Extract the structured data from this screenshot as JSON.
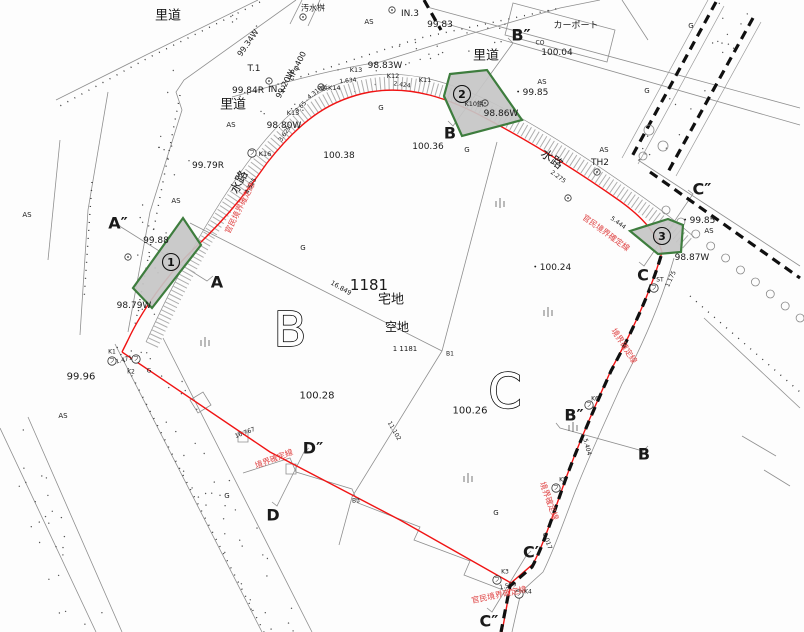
{
  "map": {
    "colors": {
      "boundary_red": "#f01414",
      "red_text": "#e04848",
      "line_gray": "#8f8f8f",
      "tick_gray": "#aeaeae",
      "text_black": "#1a1a1a",
      "parcel_fill": "#c6c6c6",
      "parcel_stroke": "#3e7d3e"
    },
    "labels": [
      {
        "id": "rido-1",
        "t": "里道",
        "x": 168,
        "y": 16,
        "s": 13
      },
      {
        "id": "osuimasu",
        "t": "汚水桝",
        "x": 313,
        "y": 8,
        "s": 8
      },
      {
        "id": "as-1",
        "t": "AS",
        "x": 369,
        "y": 22,
        "s": 7
      },
      {
        "id": "in3",
        "t": "IN.3",
        "x": 410,
        "y": 14,
        "s": 9
      },
      {
        "id": "elev-99-83",
        "t": "99.83",
        "x": 440,
        "y": 25,
        "s": 9
      },
      {
        "id": "sec-b2-top",
        "t": "B″",
        "x": 521,
        "y": 35,
        "s": 16,
        "b": 1
      },
      {
        "id": "co",
        "t": "CO",
        "x": 540,
        "y": 43,
        "s": 6
      },
      {
        "id": "carport",
        "t": "カーポート",
        "x": 576,
        "y": 26,
        "s": 9
      },
      {
        "id": "elev-100-04",
        "t": "100.04",
        "x": 557,
        "y": 53,
        "s": 9
      },
      {
        "id": "rido-2",
        "t": "里道",
        "x": 486,
        "y": 56,
        "s": 13
      },
      {
        "id": "elev-99-34w",
        "t": "99.34W",
        "x": 248,
        "y": 43,
        "s": 8,
        "r": -55
      },
      {
        "id": "t1",
        "t": "T.1",
        "x": 254,
        "y": 69,
        "s": 9
      },
      {
        "id": "hp400",
        "t": "HPφ400",
        "x": 297,
        "y": 66,
        "s": 8,
        "r": -63
      },
      {
        "id": "elev-99-20w",
        "t": "99.20W",
        "x": 285,
        "y": 84,
        "s": 8,
        "r": -63
      },
      {
        "id": "elev-99-84r",
        "t": "99.84R",
        "x": 248,
        "y": 91,
        "s": 9
      },
      {
        "id": "in2",
        "t": "IN.2",
        "x": 277,
        "y": 90,
        "s": 9
      },
      {
        "id": "rido-3",
        "t": "里道",
        "x": 233,
        "y": 105,
        "s": 13
      },
      {
        "id": "k13",
        "t": "K13",
        "x": 356,
        "y": 70,
        "s": 6.5
      },
      {
        "id": "elev-98-83w",
        "t": "98.83W",
        "x": 385,
        "y": 66,
        "s": 9
      },
      {
        "id": "k12",
        "t": "K12",
        "x": 393,
        "y": 76,
        "s": 6.5
      },
      {
        "id": "k11",
        "t": "K11",
        "x": 425,
        "y": 80,
        "s": 6.5
      },
      {
        "id": "k14",
        "t": "鋲K14",
        "x": 331,
        "y": 88,
        "s": 6.5
      },
      {
        "id": "k15",
        "t": "K15",
        "x": 293,
        "y": 113,
        "s": 6.5
      },
      {
        "id": "elev-98-80w",
        "t": "98.80W",
        "x": 284,
        "y": 126,
        "s": 9
      },
      {
        "id": "as-2",
        "t": "AS",
        "x": 231,
        "y": 125,
        "s": 7
      },
      {
        "id": "k16",
        "t": "K16",
        "x": 265,
        "y": 154,
        "s": 6.5
      },
      {
        "id": "elev-99-79r",
        "t": "99.79R",
        "x": 208,
        "y": 166,
        "s": 9
      },
      {
        "id": "suiro-1",
        "t": "水路",
        "x": 239,
        "y": 182,
        "s": 12,
        "r": -63
      },
      {
        "id": "as-3",
        "t": "AS",
        "x": 176,
        "y": 201,
        "s": 7
      },
      {
        "id": "as-4",
        "t": "AS",
        "x": 27,
        "y": 215,
        "s": 7
      },
      {
        "id": "g-1",
        "t": "G",
        "x": 381,
        "y": 108,
        "s": 7
      },
      {
        "id": "g-2",
        "t": "G",
        "x": 467,
        "y": 150,
        "s": 7
      },
      {
        "id": "elev-100-38",
        "t": "100.38",
        "x": 339,
        "y": 156,
        "s": 9
      },
      {
        "id": "elev-100-36",
        "t": "100.36",
        "x": 428,
        "y": 147,
        "s": 9
      },
      {
        "id": "sec-b-top",
        "t": "B",
        "x": 450,
        "y": 133,
        "s": 16,
        "b": 1
      },
      {
        "id": "suiro-2",
        "t": "水路",
        "x": 552,
        "y": 159,
        "s": 12,
        "r": 36
      },
      {
        "id": "as-5",
        "t": "AS",
        "x": 604,
        "y": 150,
        "s": 7
      },
      {
        "id": "th2",
        "t": "TH2",
        "x": 600,
        "y": 163,
        "s": 9
      },
      {
        "id": "k10",
        "t": "K10鋲",
        "x": 474,
        "y": 104,
        "s": 6.5
      },
      {
        "id": "elev-98-86w",
        "t": "98.86W",
        "x": 501,
        "y": 114,
        "s": 9
      },
      {
        "id": "elev-99-85a",
        "t": "・99.85",
        "x": 531,
        "y": 93,
        "s": 9
      },
      {
        "id": "as-6",
        "t": "AS",
        "x": 542,
        "y": 82,
        "s": 7
      },
      {
        "id": "g-3",
        "t": "G",
        "x": 691,
        "y": 26,
        "s": 7
      },
      {
        "id": "g-4",
        "t": "G",
        "x": 647,
        "y": 91,
        "s": 7
      },
      {
        "id": "sec-c2-top",
        "t": "C″",
        "x": 702,
        "y": 189,
        "s": 16,
        "b": 1
      },
      {
        "id": "elev-99-85b",
        "t": "・99.85",
        "x": 698,
        "y": 221,
        "s": 9
      },
      {
        "id": "as-7",
        "t": "AS",
        "x": 709,
        "y": 231,
        "s": 7
      },
      {
        "id": "elev-98-87w",
        "t": "98.87W",
        "x": 692,
        "y": 258,
        "s": 9
      },
      {
        "id": "sec-c-top",
        "t": "C",
        "x": 643,
        "y": 275,
        "s": 16,
        "b": 1
      },
      {
        "id": "elev-100-24",
        "t": "・100.24",
        "x": 551,
        "y": 268,
        "s": 9
      },
      {
        "id": "d-5444",
        "t": "5.444",
        "x": 618,
        "y": 223,
        "s": 6,
        "r": 36
      },
      {
        "id": "d-2275",
        "t": "2.275",
        "x": 558,
        "y": 177,
        "s": 6,
        "r": 36
      },
      {
        "id": "d-1175",
        "t": "1.175",
        "x": 671,
        "y": 279,
        "s": 6,
        "r": -65
      },
      {
        "id": "st",
        "t": "ST",
        "x": 660,
        "y": 280,
        "s": 6
      },
      {
        "id": "red-1",
        "t": "官民境界確定線",
        "x": 240,
        "y": 208,
        "s": 8,
        "r": -63,
        "c": "red"
      },
      {
        "id": "red-2",
        "t": "官民境界確定線",
        "x": 606,
        "y": 233,
        "s": 8,
        "r": 36,
        "c": "red"
      },
      {
        "id": "red-3",
        "t": "官民境界確定線",
        "x": 499,
        "y": 595,
        "s": 8,
        "r": -12,
        "c": "red"
      },
      {
        "id": "red-4",
        "t": "境界確定線",
        "x": 274,
        "y": 459,
        "s": 8,
        "r": -21,
        "c": "red"
      },
      {
        "id": "red-5",
        "t": "境界確定線",
        "x": 624,
        "y": 346,
        "s": 8,
        "r": 57,
        "c": "red"
      },
      {
        "id": "red-6",
        "t": "境界確定線",
        "x": 549,
        "y": 501,
        "s": 8,
        "r": 70,
        "c": "red"
      },
      {
        "id": "sec-a2",
        "t": "A″",
        "x": 118,
        "y": 223,
        "s": 16,
        "b": 1
      },
      {
        "id": "elev-99-88",
        "t": "99.88",
        "x": 156,
        "y": 241,
        "s": 9
      },
      {
        "id": "sec-a",
        "t": "A",
        "x": 217,
        "y": 282,
        "s": 16,
        "b": 1
      },
      {
        "id": "elev-98-79w",
        "t": "98.79W",
        "x": 134,
        "y": 306,
        "s": 9
      },
      {
        "id": "elev-99-96",
        "t": "99.96",
        "x": 81,
        "y": 377,
        "s": 10
      },
      {
        "id": "as-8",
        "t": "AS",
        "x": 63,
        "y": 416,
        "s": 7
      },
      {
        "id": "k1",
        "t": "K1",
        "x": 112,
        "y": 352,
        "s": 6
      },
      {
        "id": "d-1471",
        "t": "1.471",
        "x": 124,
        "y": 360,
        "s": 6,
        "r": -15
      },
      {
        "id": "k2",
        "t": "K2",
        "x": 131,
        "y": 372,
        "s": 6
      },
      {
        "id": "g-5",
        "t": "G",
        "x": 149,
        "y": 371,
        "s": 6
      },
      {
        "id": "g-6",
        "t": "G",
        "x": 303,
        "y": 248,
        "s": 7
      },
      {
        "id": "lot-1181",
        "t": "1181",
        "x": 369,
        "y": 285,
        "s": 15
      },
      {
        "id": "takuchi",
        "t": "宅地",
        "x": 391,
        "y": 300,
        "s": 13
      },
      {
        "id": "akichi",
        "t": "空地",
        "x": 397,
        "y": 327,
        "s": 12
      },
      {
        "id": "lot-ref",
        "t": "1 1181",
        "x": 405,
        "y": 349,
        "s": 7
      },
      {
        "id": "b1",
        "t": "B1",
        "x": 450,
        "y": 354,
        "s": 6
      },
      {
        "id": "d-16849",
        "t": "16.849",
        "x": 341,
        "y": 288,
        "s": 6.5,
        "r": 30
      },
      {
        "id": "elev-100-28",
        "t": "100.28",
        "x": 317,
        "y": 396,
        "s": 10
      },
      {
        "id": "elev-100-26",
        "t": "100.26",
        "x": 470,
        "y": 411,
        "s": 10
      },
      {
        "id": "parcel-b",
        "t": "B",
        "x": 290,
        "y": 330,
        "s": 48,
        "o": 1
      },
      {
        "id": "parcel-c",
        "t": "C",
        "x": 505,
        "y": 392,
        "s": 48,
        "o": 1
      },
      {
        "id": "sec-b2-right",
        "t": "B″",
        "x": 574,
        "y": 415,
        "s": 16,
        "b": 1
      },
      {
        "id": "sec-b-right",
        "t": "B",
        "x": 644,
        "y": 454,
        "s": 16,
        "b": 1
      },
      {
        "id": "k6",
        "t": "K6",
        "x": 595,
        "y": 399,
        "s": 6
      },
      {
        "id": "k5",
        "t": "K5",
        "x": 563,
        "y": 480,
        "s": 6
      },
      {
        "id": "d-5404",
        "t": "5.404",
        "x": 587,
        "y": 447,
        "s": 6,
        "r": 75
      },
      {
        "id": "d-8017",
        "t": "8.017",
        "x": 547,
        "y": 541,
        "s": 6,
        "r": 70
      },
      {
        "id": "sec-d2",
        "t": "D″",
        "x": 313,
        "y": 448,
        "s": 16,
        "b": 1
      },
      {
        "id": "sec-d",
        "t": "D",
        "x": 273,
        "y": 515,
        "s": 16,
        "b": 1
      },
      {
        "id": "d-16767",
        "t": "16.767",
        "x": 245,
        "y": 433,
        "s": 6,
        "r": -21
      },
      {
        "id": "d-11102",
        "t": "11.102",
        "x": 394,
        "y": 431,
        "s": 6,
        "r": 60
      },
      {
        "id": "b3",
        "t": "B3",
        "x": 356,
        "y": 501,
        "s": 6
      },
      {
        "id": "g-7",
        "t": "G",
        "x": 227,
        "y": 496,
        "s": 7
      },
      {
        "id": "g-8",
        "t": "G",
        "x": 496,
        "y": 513,
        "s": 7
      },
      {
        "id": "sec-c1",
        "t": "C′",
        "x": 531,
        "y": 552,
        "s": 16,
        "b": 1
      },
      {
        "id": "k3",
        "t": "K3",
        "x": 505,
        "y": 572,
        "s": 6
      },
      {
        "id": "d-1509",
        "t": "1.509",
        "x": 508,
        "y": 586,
        "s": 6,
        "r": -12
      },
      {
        "id": "k4",
        "t": "K4",
        "x": 528,
        "y": 592,
        "s": 6
      },
      {
        "id": "sec-c2-bot",
        "t": "C″",
        "x": 489,
        "y": 621,
        "s": 16,
        "b": 1
      },
      {
        "id": "d-1634",
        "t": "1.634",
        "x": 348,
        "y": 81,
        "s": 6,
        "r": -6
      },
      {
        "id": "d-2424",
        "t": "2.424",
        "x": 402,
        "y": 85,
        "s": 6,
        "r": 8
      },
      {
        "id": "d-4318",
        "t": "4.318",
        "x": 315,
        "y": 93,
        "s": 6,
        "r": -38
      },
      {
        "id": "d-365",
        "t": "3.65",
        "x": 301,
        "y": 107,
        "s": 6,
        "r": -46
      },
      {
        "id": "d-3629",
        "t": "3.629",
        "x": 285,
        "y": 134,
        "s": 6,
        "r": -56
      },
      {
        "id": "d-4525",
        "t": "4.525",
        "x": 251,
        "y": 186,
        "s": 6,
        "r": -60
      }
    ],
    "circled_points": [
      {
        "n": "1",
        "x": 171,
        "y": 262
      },
      {
        "n": "2",
        "x": 462,
        "y": 94
      },
      {
        "n": "3",
        "x": 662,
        "y": 236
      }
    ],
    "highlight_parcels": [
      {
        "name": "strip-1",
        "points": [
          [
            133,
            288
          ],
          [
            183,
            218
          ],
          [
            201,
            245
          ],
          [
            152,
            308
          ]
        ]
      },
      {
        "name": "strip-2",
        "points": [
          [
            450,
            74
          ],
          [
            487,
            70
          ],
          [
            522,
            120
          ],
          [
            462,
            136
          ],
          [
            444,
            96
          ]
        ]
      },
      {
        "name": "strip-3",
        "points": [
          [
            630,
            231
          ],
          [
            668,
            219
          ],
          [
            683,
            225
          ],
          [
            681,
            252
          ],
          [
            658,
            254
          ]
        ]
      }
    ],
    "fu_markers": [
      {
        "x": 112,
        "y": 361
      },
      {
        "x": 136,
        "y": 359
      },
      {
        "x": 252,
        "y": 153
      },
      {
        "x": 556,
        "y": 488
      },
      {
        "x": 589,
        "y": 405
      },
      {
        "x": 497,
        "y": 580
      },
      {
        "x": 519,
        "y": 594
      },
      {
        "x": 654,
        "y": 288
      }
    ],
    "bench_markers": [
      [
        303,
        17
      ],
      [
        392,
        10
      ],
      [
        269,
        81
      ],
      [
        597,
        172
      ],
      [
        128,
        257
      ],
      [
        568,
        198
      ],
      [
        485,
        103
      ],
      [
        321,
        87
      ]
    ],
    "grass_symbols": [
      [
        500,
        203
      ],
      [
        548,
        312
      ],
      [
        205,
        342
      ],
      [
        468,
        478
      ],
      [
        573,
        427
      ]
    ],
    "fu_glyph": "フ"
  }
}
